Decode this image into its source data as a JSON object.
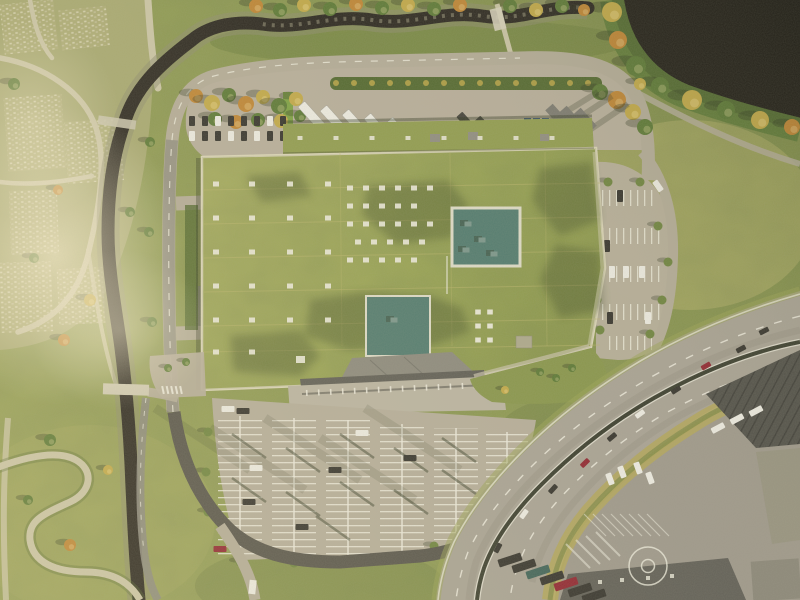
{
  "meta": {
    "title": "Aerial photograph: logistics building with green living roof, ring road, parking lots, stream and highway",
    "type": "aerial-photograph",
    "no_visible_text": true
  },
  "palette": {
    "base": "#8e9a52",
    "grassLight": "#b4b069",
    "grassDark": "#6d7c40",
    "slope": "#72823f",
    "cem": "#a7a772",
    "cemPath": "#c9c3a4",
    "roofA": "#a6ab5e",
    "roofB": "#8a964a",
    "wing": "#909b4f",
    "roofShade": "#2f3a1c",
    "seam": "#b9b36a",
    "parapet": "#d9d3b6",
    "teal": "#527a6e",
    "tealEdge": "#dcd9c6",
    "tealUnit": "#7b958a",
    "yard": "#b6ad9a",
    "roadLight": "#b2aa96",
    "roadMid": "#8b887c",
    "roadDark": "#56534a",
    "sidewalk": "#c6bfa8",
    "hwy": "#a7a193",
    "median": "#3a3d2e",
    "marking": "#ebe8da",
    "worn": "#8e897a",
    "stream": "#2b2720",
    "bank": "#8d8c6e",
    "rock": "#97937a",
    "lake": "#232019",
    "treeG": "#5c7836",
    "treeY": "#c0a748",
    "treeO": "#bd8434",
    "hedge": "#536830",
    "bush": "#6e833f",
    "carDark": "#35332d",
    "carRed": "#8f2530",
    "carWhite": "#ebe9e0",
    "tealCar": "#3f6258",
    "canopy": "#5f5d55",
    "canopyLight": "#8b887c",
    "apron": "#b9b2a0",
    "ware": "#504f48",
    "ware2": "#605e56",
    "indYard": "#9d978a",
    "embank": "#b1a45c",
    "shadow": "#2e3520",
    "blue": "#3f5a78",
    "wall": "#7da043",
    "equip": "#8f8c80",
    "grayTruck": "#7b7970"
  },
  "roof": {
    "vents_sparse": [
      [
        216,
        184
      ],
      [
        252,
        184
      ],
      [
        290,
        184
      ],
      [
        328,
        184
      ],
      [
        216,
        218
      ],
      [
        252,
        218
      ],
      [
        290,
        218
      ],
      [
        328,
        218
      ],
      [
        216,
        252
      ],
      [
        252,
        252
      ],
      [
        290,
        252
      ],
      [
        328,
        252
      ],
      [
        216,
        286
      ],
      [
        252,
        286
      ],
      [
        290,
        286
      ],
      [
        328,
        286
      ],
      [
        216,
        320
      ],
      [
        252,
        320
      ],
      [
        290,
        320
      ],
      [
        328,
        320
      ],
      [
        216,
        352
      ],
      [
        252,
        352
      ]
    ],
    "vents_cluster": [
      [
        350,
        188
      ],
      [
        366,
        188
      ],
      [
        382,
        188
      ],
      [
        398,
        188
      ],
      [
        414,
        188
      ],
      [
        430,
        188
      ],
      [
        350,
        206
      ],
      [
        366,
        206
      ],
      [
        382,
        206
      ],
      [
        398,
        206
      ],
      [
        414,
        206
      ],
      [
        350,
        224
      ],
      [
        366,
        224
      ],
      [
        382,
        224
      ],
      [
        398,
        224
      ],
      [
        414,
        224
      ],
      [
        430,
        224
      ],
      [
        358,
        242
      ],
      [
        374,
        242
      ],
      [
        390,
        242
      ],
      [
        406,
        242
      ],
      [
        422,
        242
      ],
      [
        350,
        260
      ],
      [
        366,
        260
      ],
      [
        382,
        260
      ],
      [
        398,
        260
      ],
      [
        414,
        260
      ]
    ],
    "vents_wing_x": [
      300,
      336,
      372,
      408,
      444,
      480,
      516,
      552
    ],
    "vent_pairs": [
      [
        478,
        312
      ],
      [
        490,
        312
      ],
      [
        478,
        326
      ],
      [
        490,
        326
      ],
      [
        478,
        340
      ],
      [
        490,
        340
      ]
    ],
    "seams_h": [
      190,
      224,
      258,
      292,
      326,
      352
    ],
    "seams_v": [
      340,
      450,
      545
    ],
    "teal1": [
      452,
      208,
      68,
      58
    ],
    "teal2": [
      366,
      296,
      64,
      60
    ],
    "teal_units": [
      [
        468,
        224
      ],
      [
        482,
        240
      ],
      [
        494,
        254
      ],
      [
        466,
        250
      ],
      [
        394,
        320
      ]
    ],
    "white_unit": [
      300,
      360
    ],
    "shadow_polys": [
      "310,300 360,292 430,296 462,308 470,332 430,346 350,350 305,336",
      "368,186 448,180 468,206 452,238 396,244 362,214",
      "540,168 592,162 600,220 560,236 532,200",
      "556,244 600,252 604,310 560,318 540,280",
      "230,336 300,330 320,356 300,376 234,372",
      "246,176 300,172 312,196 262,202"
    ]
  },
  "yard": {
    "trees_left": [
      [
        196,
        96,
        7,
        "o"
      ],
      [
        212,
        103,
        8,
        "y"
      ],
      [
        229,
        95,
        7,
        "g"
      ],
      [
        246,
        104,
        8,
        "o"
      ],
      [
        263,
        97,
        7,
        "y"
      ],
      [
        279,
        106,
        8,
        "g"
      ],
      [
        296,
        99,
        7,
        "y"
      ],
      [
        215,
        119,
        7,
        "g"
      ],
      [
        236,
        122,
        7,
        "o"
      ],
      [
        258,
        120,
        7,
        "g"
      ],
      [
        281,
        121,
        7,
        "y"
      ],
      [
        300,
        116,
        6,
        "g"
      ]
    ],
    "trees_right": [
      [
        600,
        92,
        8,
        "g"
      ],
      [
        617,
        100,
        9,
        "o"
      ],
      [
        633,
        112,
        8,
        "y"
      ],
      [
        645,
        127,
        8,
        "g"
      ],
      [
        640,
        84,
        6,
        "y"
      ]
    ],
    "hedge": [
      330,
      77,
      272,
      13
    ],
    "trailers": [
      [
        312,
        116
      ],
      [
        334,
        120
      ],
      [
        356,
        124
      ],
      [
        378,
        128
      ],
      [
        400,
        132
      ],
      [
        422,
        136
      ],
      [
        444,
        140
      ]
    ],
    "trucks_dark": [
      [
        468,
        124
      ],
      [
        486,
        128
      ],
      [
        503,
        132
      ]
    ],
    "bins": [
      [
        524,
        118
      ],
      [
        533,
        118
      ],
      [
        542,
        118
      ],
      [
        524,
        131
      ],
      [
        533,
        131
      ],
      [
        542,
        131
      ]
    ],
    "containers": [
      [
        557,
        116
      ],
      [
        571,
        118
      ],
      [
        585,
        120
      ]
    ],
    "cars_row1": [
      [
        192,
        "d"
      ],
      [
        205,
        "d"
      ],
      [
        218,
        "w"
      ],
      [
        231,
        "d"
      ],
      [
        244,
        "d"
      ],
      [
        257,
        "d"
      ],
      [
        270,
        "w"
      ],
      [
        283,
        "d"
      ]
    ],
    "cars_row2": [
      [
        192,
        "w"
      ],
      [
        205,
        "d"
      ],
      [
        218,
        "d"
      ],
      [
        231,
        "w"
      ],
      [
        244,
        "d"
      ],
      [
        257,
        "w"
      ],
      [
        270,
        "d"
      ],
      [
        283,
        "d"
      ]
    ],
    "shadow_streaks": [
      [
        612,
        96,
        548,
        138
      ],
      [
        628,
        104,
        566,
        146
      ],
      [
        598,
        92,
        540,
        128
      ]
    ]
  },
  "lot": {
    "groups": [
      [
        218,
        416,
        44,
        140
      ],
      [
        272,
        418,
        44,
        140
      ],
      [
        326,
        420,
        44,
        138
      ],
      [
        380,
        424,
        44,
        130
      ],
      [
        434,
        428,
        44,
        112
      ],
      [
        486,
        432,
        42,
        74
      ]
    ],
    "pole_shadows": [
      [
        266,
        458
      ],
      [
        266,
        502
      ],
      [
        320,
        472
      ],
      [
        320,
        516
      ],
      [
        374,
        458
      ],
      [
        374,
        506
      ],
      [
        428,
        472
      ],
      [
        428,
        514
      ],
      [
        476,
        462
      ],
      [
        476,
        494
      ],
      [
        240,
        532
      ],
      [
        350,
        540
      ]
    ],
    "streaks": [
      [
        250,
        470
      ],
      [
        305,
        490
      ],
      [
        360,
        480
      ],
      [
        415,
        500
      ],
      [
        460,
        470
      ]
    ],
    "cars": [
      [
        256,
        468,
        "w"
      ],
      [
        249,
        502,
        "d"
      ],
      [
        302,
        527,
        "d"
      ],
      [
        220,
        549,
        "r"
      ],
      [
        362,
        433,
        "w"
      ],
      [
        410,
        458,
        "d"
      ],
      [
        228,
        409,
        "w"
      ],
      [
        243,
        411,
        "d"
      ],
      [
        335,
        470,
        "d"
      ]
    ],
    "bushes": [
      [
        240,
        562
      ],
      [
        294,
        563
      ],
      [
        348,
        562
      ],
      [
        402,
        558
      ],
      [
        434,
        546
      ],
      [
        208,
        432
      ],
      [
        206,
        472
      ],
      [
        208,
        512
      ]
    ]
  },
  "east": {
    "rows": [
      [
        600,
        190,
        56,
        16
      ],
      [
        601,
        228,
        64,
        16
      ],
      [
        599,
        266,
        66,
        16
      ],
      [
        602,
        304,
        60,
        16
      ],
      [
        604,
        336,
        48,
        14
      ]
    ],
    "cars": [
      [
        612,
        272,
        "w"
      ],
      [
        626,
        272,
        "w"
      ],
      [
        642,
        272,
        "w"
      ],
      [
        607,
        246,
        "d"
      ],
      [
        620,
        196,
        "d"
      ],
      [
        648,
        318,
        "w"
      ],
      [
        610,
        318,
        "d"
      ]
    ],
    "bushes": [
      [
        597,
        222
      ],
      [
        658,
        226
      ],
      [
        596,
        260
      ],
      [
        668,
        262
      ],
      [
        597,
        300
      ],
      [
        662,
        300
      ],
      [
        600,
        330
      ],
      [
        650,
        334
      ],
      [
        608,
        182
      ],
      [
        640,
        182
      ]
    ],
    "road_vehicle": [
      658,
      186,
      -35
    ]
  },
  "highway": {
    "cars": [
      [
        764,
        331,
        63,
        "d"
      ],
      [
        741,
        349,
        62,
        "d"
      ],
      [
        706,
        366,
        60,
        "r"
      ],
      [
        676,
        390,
        57,
        "d"
      ],
      [
        640,
        414,
        54,
        "w"
      ],
      [
        612,
        437,
        50,
        "d"
      ],
      [
        585,
        463,
        46,
        "r"
      ],
      [
        553,
        489,
        42,
        "d"
      ],
      [
        524,
        514,
        36,
        "w"
      ],
      [
        498,
        548,
        28,
        "d"
      ]
    ]
  },
  "industrial": {
    "circle": [
      648,
      566,
      19,
      6.5
    ],
    "trailers": [
      [
        510,
        560,
        "d"
      ],
      [
        524,
        566,
        "d"
      ],
      [
        538,
        572,
        "t"
      ],
      [
        552,
        578,
        "d"
      ],
      [
        566,
        584,
        "r"
      ],
      [
        580,
        590,
        "d"
      ],
      [
        594,
        596,
        "d"
      ]
    ],
    "white_trucks_rot": [
      [
        718,
        428,
        62
      ],
      [
        737,
        419,
        62
      ],
      [
        756,
        411,
        62
      ]
    ],
    "white_trucks": [
      [
        650,
        478
      ],
      [
        638,
        468
      ],
      [
        622,
        472
      ],
      [
        610,
        479
      ]
    ],
    "chevrons": [
      [
        566,
        544,
        590,
        568
      ],
      [
        576,
        540,
        600,
        564
      ],
      [
        586,
        536,
        610,
        560
      ],
      [
        596,
        532,
        620,
        556
      ]
    ],
    "roof_dots": [
      [
        600,
        582
      ],
      [
        622,
        580
      ],
      [
        648,
        578
      ],
      [
        672,
        576
      ]
    ]
  },
  "trees": {
    "shore": [
      [
        612,
        12,
        10,
        "y"
      ],
      [
        618,
        40,
        9,
        "o"
      ],
      [
        636,
        66,
        10,
        "g"
      ],
      [
        660,
        86,
        9,
        "g"
      ],
      [
        692,
        100,
        10,
        "y"
      ],
      [
        726,
        110,
        9,
        "g"
      ],
      [
        760,
        120,
        9,
        "y"
      ],
      [
        792,
        127,
        8,
        "o"
      ]
    ],
    "ravine_top": [
      [
        256,
        6,
        7,
        "o"
      ],
      [
        280,
        10,
        7,
        "g"
      ],
      [
        304,
        5,
        7,
        "y"
      ],
      [
        330,
        9,
        7,
        "g"
      ],
      [
        356,
        4,
        7,
        "o"
      ],
      [
        382,
        8,
        7,
        "g"
      ],
      [
        408,
        5,
        7,
        "y"
      ],
      [
        434,
        9,
        7,
        "g"
      ],
      [
        460,
        5,
        7,
        "o"
      ],
      [
        510,
        6,
        7,
        "g"
      ],
      [
        536,
        10,
        7,
        "y"
      ],
      [
        562,
        6,
        7,
        "g"
      ],
      [
        584,
        10,
        6,
        "o"
      ]
    ],
    "cemetery": [
      [
        14,
        84,
        6,
        "g"
      ],
      [
        58,
        190,
        5,
        "o"
      ],
      [
        34,
        258,
        5,
        "g"
      ],
      [
        90,
        300,
        6,
        "y"
      ],
      [
        130,
        212,
        5,
        "g"
      ],
      [
        64,
        340,
        6,
        "o"
      ]
    ],
    "west_strip": [
      [
        150,
        142,
        5,
        "g"
      ],
      [
        149,
        232,
        5,
        "g"
      ],
      [
        152,
        322,
        5,
        "g"
      ]
    ],
    "sw_lawn": [
      [
        50,
        440,
        6,
        "g"
      ],
      [
        28,
        500,
        5,
        "g"
      ],
      [
        70,
        545,
        6,
        "o"
      ],
      [
        108,
        470,
        5,
        "y"
      ],
      [
        168,
        368,
        4,
        "g"
      ],
      [
        186,
        362,
        4,
        "g"
      ]
    ],
    "se_lawn": [
      [
        540,
        372,
        4,
        "g"
      ],
      [
        556,
        378,
        4,
        "g"
      ],
      [
        572,
        368,
        4,
        "g"
      ],
      [
        505,
        390,
        4,
        "y"
      ]
    ]
  },
  "cemetery": {
    "patches": [
      [
        6,
        96,
        58,
        74,
        -4
      ],
      [
        66,
        120,
        56,
        62,
        -4
      ],
      [
        10,
        190,
        48,
        64,
        -2
      ],
      [
        0,
        262,
        52,
        70,
        -2
      ],
      [
        58,
        268,
        46,
        56,
        -3
      ],
      [
        2,
        2,
        54,
        50,
        -6
      ],
      [
        60,
        8,
        48,
        40,
        -6
      ]
    ]
  }
}
